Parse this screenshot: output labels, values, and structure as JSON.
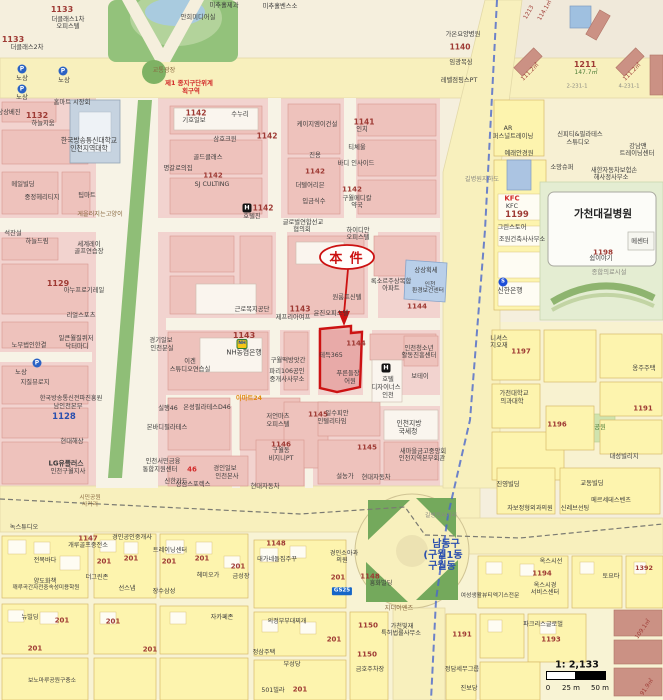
{
  "annotation": {
    "label": "本 件"
  },
  "scale": {
    "ratio": "1: 2,133",
    "tick0": "0",
    "tick25": "25 m",
    "tick50": "50 m"
  },
  "colors": {
    "highlight": "#cc1212",
    "district_text": "#3a57c0",
    "zone_text": "#d22a2a",
    "parcel_number": "#9e3a34",
    "road_fill": "#f8f0bd",
    "block_pink": "#f2d3cf",
    "block_yellow": "#fdf4ae",
    "park_green": "#8fbe77",
    "transit_line": "#4a66cc"
  },
  "label_colors": {
    "k": "#3b3b3b",
    "dk": "#222222",
    "r": "#9e3a34",
    "R": "#d22a2a",
    "b": "#2a4fae",
    "g": "#4e7d37",
    "o": "#e08a12",
    "br": "#8a6a42",
    "gy": "#8a8a82"
  },
  "labels": [
    [
      "1133",
      62,
      10,
      8,
      "r",
      1
    ],
    [
      "더클래스1차",
      68,
      20,
      6.3
    ],
    [
      "오피스텔",
      68,
      27,
      6.3
    ],
    [
      "1133",
      13,
      40,
      8,
      "r",
      1
    ],
    [
      "더클래스2차",
      27,
      48,
      6.3
    ],
    [
      "안희미디어실",
      198,
      18,
      6.3
    ],
    [
      "미추홀제과",
      224,
      6,
      6.3
    ],
    [
      "미추홀벤스소",
      280,
      7,
      6.3
    ],
    [
      "노상",
      22,
      78,
      6.5
    ],
    [
      "노상",
      64,
      80,
      6.5
    ],
    [
      "노상",
      22,
      97,
      6.5
    ],
    [
      "교통광장",
      164,
      71,
      6.2,
      "br"
    ],
    [
      "제1 종지구단위계",
      189,
      83,
      6.4,
      "R",
      1
    ],
    [
      "획구역",
      191,
      91,
      6.4,
      "R",
      1
    ],
    [
      "홈마트 시장회",
      72,
      103,
      6.3
    ],
    [
      "상상베진",
      9,
      113,
      6.3
    ],
    [
      "1132",
      37,
      116,
      8,
      "r",
      1
    ],
    [
      "하늘지움",
      43,
      124,
      6.3
    ],
    [
      "한국방송통신대학교",
      89,
      141,
      6.8
    ],
    [
      "인천지역대학",
      89,
      149,
      6.8
    ],
    [
      "1142",
      196,
      113,
      7.5,
      "r",
      1
    ],
    [
      "기호일보",
      194,
      121,
      6.3
    ],
    [
      "수누리",
      240,
      115,
      6.3
    ],
    [
      "삼호크윈",
      225,
      140,
      6.3
    ],
    [
      "1142",
      267,
      136,
      7.5,
      "r",
      1
    ],
    [
      "골드클래스",
      208,
      158,
      6.3
    ],
    [
      "명갈로의집",
      178,
      169,
      6.3
    ],
    [
      "1142",
      213,
      176,
      7,
      "r",
      1
    ],
    [
      "SJ CULTING",
      212,
      185,
      6.3
    ],
    [
      "1142",
      263,
      208,
      7.5,
      "r",
      1
    ],
    [
      "호텔진",
      252,
      217,
      6.3
    ],
    [
      "케이지엠이건설",
      317,
      125,
      6.3
    ],
    [
      "1141",
      364,
      122,
      7.5,
      "r",
      1
    ],
    [
      "인치",
      362,
      130,
      6.3
    ],
    [
      "진용",
      315,
      156,
      6.3
    ],
    [
      "티체울",
      357,
      148,
      6.3
    ],
    [
      "바디 인사이드",
      356,
      164,
      6.3
    ],
    [
      "1142",
      315,
      171,
      7.2,
      "r",
      1
    ],
    [
      "더텔어리븐",
      310,
      186,
      6.3
    ],
    [
      "1142",
      352,
      189,
      7.2,
      "r",
      1
    ],
    [
      "구월메디칼",
      357,
      199,
      6.3
    ],
    [
      "약국",
      357,
      206,
      6.3
    ],
    [
      "입금식수",
      314,
      202,
      6.3
    ],
    [
      "글로벌연합선교",
      303,
      223,
      6.3
    ],
    [
      "협의회",
      302,
      230,
      6.3
    ],
    [
      "하이디안",
      358,
      231,
      6.3
    ],
    [
      "오피스텔",
      358,
      238,
      6.3
    ],
    [
      "게을러지는고양이",
      100,
      215,
      6.2,
      "br"
    ],
    [
      "메일빌딩",
      23,
      185,
      6.3
    ],
    [
      "중정헤리티지",
      42,
      198,
      6.3
    ],
    [
      "팁마트",
      87,
      196,
      6.3
    ],
    [
      "석잔설",
      13,
      234,
      6.3
    ],
    [
      "하늘드림",
      37,
      242,
      6.3
    ],
    [
      "세계레이",
      89,
      245,
      6.3
    ],
    [
      "골프연습장",
      89,
      252,
      6.3
    ],
    [
      "1129",
      58,
      284,
      8,
      "r",
      1
    ],
    [
      "아누프로기레일",
      84,
      291,
      6.3
    ],
    [
      "리얼스포츠",
      81,
      316,
      6.3
    ],
    [
      "노무법인한결",
      29,
      346,
      6.3
    ],
    [
      "일큰월질퀴저",
      76,
      339,
      6.3
    ],
    [
      "닥터마디",
      77,
      347,
      6.3
    ],
    [
      "노상",
      21,
      372,
      6.5
    ],
    [
      "지질뷰로지",
      35,
      383,
      6.3
    ],
    [
      "한국방송통신전파진흥원",
      71,
      399,
      6.2
    ],
    [
      "남인천본부",
      68,
      407,
      6.3
    ],
    [
      "1128",
      64,
      417,
      8.5,
      "b",
      1
    ],
    [
      "현대해상",
      72,
      442,
      6.3
    ],
    [
      "LG유플러스",
      66,
      464,
      6.8,
      "k",
      1
    ],
    [
      "인천구월지사",
      68,
      472,
      6.3
    ],
    [
      "근로복지공단",
      252,
      310,
      6.3
    ],
    [
      "1143",
      300,
      309,
      7.5,
      "r",
      1
    ],
    [
      "윤진오피스텔",
      331,
      314,
      6.3
    ],
    [
      "제프리아여프",
      293,
      318,
      6.3
    ],
    [
      "록소르주상복합",
      391,
      282,
      6.3
    ],
    [
      "아파트",
      391,
      289,
      6.3
    ],
    [
      "원룸프신텔",
      347,
      298,
      6.3
    ],
    [
      "상상획세",
      426,
      271,
      6.3
    ],
    [
      "인천",
      430,
      286,
      5.8
    ],
    [
      "환경보건센터",
      428,
      292,
      5.8
    ],
    [
      "1144",
      417,
      306,
      7.2,
      "r",
      1
    ],
    [
      "1144",
      356,
      344,
      7,
      "r",
      1
    ],
    [
      "테득365",
      331,
      356,
      6.3
    ],
    [
      "푸른들장",
      348,
      374,
      6.3
    ],
    [
      "어원",
      350,
      382,
      6.3
    ],
    [
      "인천청소년",
      419,
      349,
      6.3
    ],
    [
      "활동진흥센터",
      419,
      356,
      6.3
    ],
    [
      "보테이",
      420,
      377,
      6.3
    ],
    [
      "호텔",
      388,
      380,
      6.3
    ],
    [
      "디자이너스",
      386,
      388,
      6.3
    ],
    [
      "인천",
      388,
      396,
      6.3
    ],
    [
      "1143",
      244,
      336,
      8,
      "r",
      1
    ],
    [
      "NH농협은행",
      244,
      353,
      6.8
    ],
    [
      "경기일보",
      161,
      341,
      6.3
    ],
    [
      "인천분실",
      162,
      349,
      6.3
    ],
    [
      "이겐",
      190,
      362,
      6.3
    ],
    [
      "스튜디오연습실",
      190,
      370,
      6.3
    ],
    [
      "구월떡방앗간",
      288,
      361,
      6.3
    ],
    [
      "파리106공인",
      287,
      372,
      6.3
    ],
    [
      "중개사사무소",
      287,
      380,
      6.3
    ],
    [
      "실행46",
      168,
      409,
      6.3
    ],
    [
      "온성필라테스D46",
      207,
      408,
      6.3
    ],
    [
      "이마트24",
      249,
      399,
      6.3,
      "o",
      1
    ],
    [
      "저언마츠",
      278,
      417,
      6.3
    ],
    [
      "오피스텔",
      278,
      425,
      6.3
    ],
    [
      "본바디필라테스",
      167,
      428,
      6.3
    ],
    [
      "1146",
      281,
      444,
      7.2,
      "r",
      1
    ],
    [
      "구월동",
      281,
      451,
      6.3
    ],
    [
      "비지니PT",
      281,
      459,
      6.3
    ],
    [
      "인천서민금융",
      163,
      462,
      6.3
    ],
    [
      "통합지원센터",
      160,
      470,
      6.3
    ],
    [
      "46",
      192,
      470,
      7,
      "R",
      1
    ],
    [
      "신한카드",
      176,
      482,
      6.3
    ],
    [
      "경인일보",
      225,
      469,
      6.3
    ],
    [
      "인천본사",
      227,
      477,
      6.3
    ],
    [
      "성심스포렉스",
      193,
      485,
      6.3
    ],
    [
      "현대자동차",
      265,
      487,
      6.3
    ],
    [
      "1145",
      318,
      414,
      7.2,
      "r",
      1
    ],
    [
      "일수피안",
      337,
      414,
      6.3
    ],
    [
      "인텔리타임",
      332,
      422,
      6.3
    ],
    [
      "인천지방",
      409,
      424,
      6.8
    ],
    [
      "국세청",
      408,
      432,
      6.8
    ],
    [
      "1145",
      367,
      447,
      7.2,
      "r",
      1
    ],
    [
      "새마을금고중앙회",
      423,
      452,
      6.3
    ],
    [
      "인천지역본부회관",
      422,
      459,
      6.3
    ],
    [
      "설농가",
      345,
      477,
      6.3
    ],
    [
      "현대자동차",
      376,
      478,
      6.3
    ],
    [
      "시민공원",
      90,
      499,
      5.8,
      "br"
    ],
    [
      "사거리",
      90,
      506,
      5.8,
      "br"
    ],
    [
      "가온요양병원",
      463,
      35,
      6.3
    ],
    [
      "1140",
      460,
      47,
      7.5,
      "r",
      1
    ],
    [
      "임광복싱",
      461,
      63,
      6.3
    ],
    [
      "레벨점핑스PT",
      459,
      81,
      6.3
    ],
    [
      "1211",
      585,
      65,
      8,
      "r",
      1
    ],
    [
      "147.7㎡",
      586,
      73,
      6,
      "g"
    ],
    [
      "111.2㎡",
      531,
      73,
      5.8,
      "r",
      0,
      -45
    ],
    [
      "111.2㎡",
      633,
      73,
      5.8,
      "r",
      0,
      -45
    ],
    [
      "2-231-1",
      577,
      87,
      5.4,
      "gy"
    ],
    [
      "4-231-1",
      629,
      87,
      5.4,
      "gy"
    ],
    [
      "1213",
      530,
      13,
      5.8,
      "r",
      0,
      -60
    ],
    [
      "114.1㎡",
      546,
      11,
      5.8,
      "r",
      0,
      -60
    ],
    [
      "길병원지하도",
      482,
      180,
      6.2,
      "gy"
    ],
    [
      "AR",
      508,
      129,
      6.3
    ],
    [
      "퍼스널트레이닝",
      513,
      137,
      6.3
    ],
    [
      "예래안경원",
      519,
      154,
      6.3
    ],
    [
      "신피티&필라테스",
      580,
      135,
      6.3
    ],
    [
      "스튜디오",
      578,
      143,
      6.3
    ],
    [
      "강남맨",
      638,
      147,
      6.3
    ],
    [
      "트레이닝센터",
      637,
      154,
      6.3
    ],
    [
      "소망슈퍼",
      562,
      168,
      6.3
    ],
    [
      "새한자동차보험손",
      614,
      171,
      6.3
    ],
    [
      "해사정사무소",
      611,
      178,
      6.3
    ],
    [
      "KFC",
      512,
      199,
      7,
      "R",
      1
    ],
    [
      "KFC",
      512,
      207,
      6.3
    ],
    [
      "1199",
      517,
      215,
      8.5,
      "r",
      1
    ],
    [
      "그린스토어",
      512,
      228,
      6.3
    ],
    [
      "조원건축사사무소",
      522,
      240,
      6.3
    ],
    [
      "신한은행",
      510,
      291,
      6.8
    ],
    [
      "가천대길병원",
      603,
      214,
      10.5,
      "dk",
      1
    ],
    [
      "1198",
      603,
      252,
      7.2,
      "r",
      1
    ],
    [
      "쉼이야기",
      601,
      259,
      6.3
    ],
    [
      "메센터",
      640,
      242,
      6.3
    ],
    [
      "종합의료시설",
      609,
      273,
      6.3,
      "gy"
    ],
    [
      "니셔스",
      499,
      339,
      6.3
    ],
    [
      "지오재",
      499,
      346,
      6.3
    ],
    [
      "1197",
      521,
      352,
      7,
      "r",
      1
    ],
    [
      "가천대학교",
      514,
      394,
      6.3
    ],
    [
      "의과대학",
      512,
      402,
      6.3
    ],
    [
      "옹주주택",
      644,
      369,
      6.3
    ],
    [
      "1196",
      557,
      425,
      7,
      "r",
      1
    ],
    [
      "공원",
      600,
      428,
      6.3,
      "g"
    ],
    [
      "1191",
      643,
      409,
      7,
      "r",
      1
    ],
    [
      "진영빌딩",
      508,
      485,
      6.3
    ],
    [
      "교동빌딩",
      592,
      484,
      6.3
    ],
    [
      "대성빌리지",
      624,
      457,
      6.3
    ],
    [
      "자보정형외과의원",
      530,
      509,
      6.2
    ],
    [
      "신레브선팅",
      575,
      509,
      6.2
    ],
    [
      "메르세데스벤츠",
      611,
      501,
      6.2
    ],
    [
      "남동구",
      446,
      545,
      10,
      "b",
      1
    ],
    [
      "(구월1동",
      443,
      556,
      10,
      "b",
      1
    ],
    [
      "구월동",
      442,
      567,
      10,
      "b",
      1
    ],
    [
      "길병원사거리",
      441,
      517,
      5.8,
      "gy"
    ],
    [
      "옥스시선",
      551,
      562,
      6.2
    ],
    [
      "1194",
      542,
      574,
      7,
      "r",
      1
    ],
    [
      "옥스시경",
      545,
      586,
      6.2
    ],
    [
      "서비스센터",
      545,
      593,
      6.2
    ],
    [
      "여성생활뷰티엑기스전문",
      490,
      597,
      5.8
    ],
    [
      "토요타",
      611,
      577,
      6.2
    ],
    [
      "1392",
      644,
      568,
      6.4,
      "r",
      1
    ],
    [
      "파크리스글로벌",
      543,
      625,
      6.2
    ],
    [
      "1193",
      551,
      640,
      7,
      "r",
      1
    ],
    [
      "정담세무그룹",
      462,
      670,
      6.2
    ],
    [
      "진보당",
      469,
      689,
      6.2
    ],
    [
      "91.9㎡",
      648,
      688,
      5.8,
      "r",
      0,
      -55
    ],
    [
      "109.1㎡",
      644,
      630,
      5.8,
      "r",
      0,
      -55
    ],
    [
      "녹스튜디오",
      24,
      528,
      6.2
    ],
    [
      "1147",
      88,
      539,
      7,
      "r",
      1
    ],
    [
      "개루골프중전소",
      88,
      546,
      6.2
    ],
    [
      "경인공인중개사",
      132,
      538,
      6.2
    ],
    [
      "트레이닝센터",
      170,
      551,
      6.2
    ],
    [
      "전복바다",
      45,
      561,
      6.2
    ],
    [
      "201",
      104,
      562,
      7,
      "r",
      1
    ],
    [
      "201",
      131,
      559,
      7,
      "r",
      1
    ],
    [
      "201",
      169,
      562,
      7,
      "r",
      1
    ],
    [
      "201",
      202,
      559,
      7,
      "r",
      1
    ],
    [
      "201",
      238,
      567,
      7,
      "r",
      1
    ],
    [
      "양도화책",
      45,
      582,
      6.2
    ],
    [
      "깨루곡간자전중속성미용학원",
      46,
      589,
      5.6
    ],
    [
      "더그린존",
      97,
      578,
      6.2
    ],
    [
      "선스냅",
      127,
      589,
      6.2
    ],
    [
      "장수삼성",
      164,
      592,
      6.2
    ],
    [
      "헤미오가",
      208,
      576,
      6.2
    ],
    [
      "금성장",
      241,
      577,
      6.2
    ],
    [
      "뉴빌딩",
      30,
      618,
      6.2
    ],
    [
      "201",
      62,
      621,
      7,
      "r",
      1
    ],
    [
      "201",
      113,
      622,
      7,
      "r",
      1
    ],
    [
      "201",
      35,
      649,
      7,
      "r",
      1
    ],
    [
      "201",
      150,
      650,
      7,
      "r",
      1
    ],
    [
      "보노마루공원구충소",
      52,
      682,
      5.8
    ],
    [
      "자카페존",
      222,
      618,
      6.2
    ],
    [
      "1148",
      276,
      544,
      7,
      "r",
      1
    ],
    [
      "대가네돌집주꾸",
      277,
      560,
      6.2
    ],
    [
      "경인소아과",
      344,
      554,
      6.2
    ],
    [
      "의원",
      342,
      561,
      6.2
    ],
    [
      "201",
      338,
      578,
      7,
      "r",
      1
    ],
    [
      "1148",
      370,
      577,
      7,
      "r",
      1
    ],
    [
      "흥화빌딩",
      381,
      584,
      6.2
    ],
    [
      "지더이엔즈",
      399,
      609,
      6.2,
      "br"
    ],
    [
      "1150",
      368,
      625,
      7.2,
      "r",
      1
    ],
    [
      "가천빛재",
      402,
      627,
      6.2
    ],
    [
      "특허법률사무소",
      401,
      634,
      6.2
    ],
    [
      "201",
      334,
      640,
      7,
      "r",
      1
    ],
    [
      "1150",
      367,
      654,
      7.2,
      "r",
      1
    ],
    [
      "금호주차장",
      370,
      670,
      6.2
    ],
    [
      "1191",
      462,
      635,
      7,
      "r",
      1
    ],
    [
      "정삼주택",
      264,
      653,
      6.2
    ],
    [
      "부성당",
      292,
      665,
      6.2
    ],
    [
      "501빌라",
      273,
      691,
      6.2
    ],
    [
      "201",
      300,
      690,
      7,
      "r",
      1
    ],
    [
      "의정부부대찌개",
      287,
      622,
      6
    ]
  ],
  "icons": [
    {
      "name": "parking-icon",
      "glyph": "P",
      "x": 22,
      "y": 69,
      "style": "P"
    },
    {
      "name": "parking-icon",
      "glyph": "P",
      "x": 63,
      "y": 71,
      "style": "P"
    },
    {
      "name": "parking-icon",
      "glyph": "P",
      "x": 22,
      "y": 89,
      "style": "P"
    },
    {
      "name": "parking-icon",
      "glyph": "P",
      "x": 37,
      "y": 363,
      "style": "P"
    },
    {
      "name": "hotel-icon",
      "glyph": "H",
      "x": 247,
      "y": 208,
      "style": "H"
    },
    {
      "name": "hotel-icon",
      "glyph": "H",
      "x": 386,
      "y": 368,
      "style": "H"
    },
    {
      "name": "nh-bank-icon",
      "glyph": "NH",
      "x": 242,
      "y": 344,
      "style": "NH"
    },
    {
      "name": "shinhan-bank-icon",
      "glyph": "S",
      "x": 503,
      "y": 282,
      "style": "SH"
    },
    {
      "name": "gs25-icon",
      "glyph": "GS25",
      "x": 342,
      "y": 591,
      "style": "GS"
    }
  ]
}
